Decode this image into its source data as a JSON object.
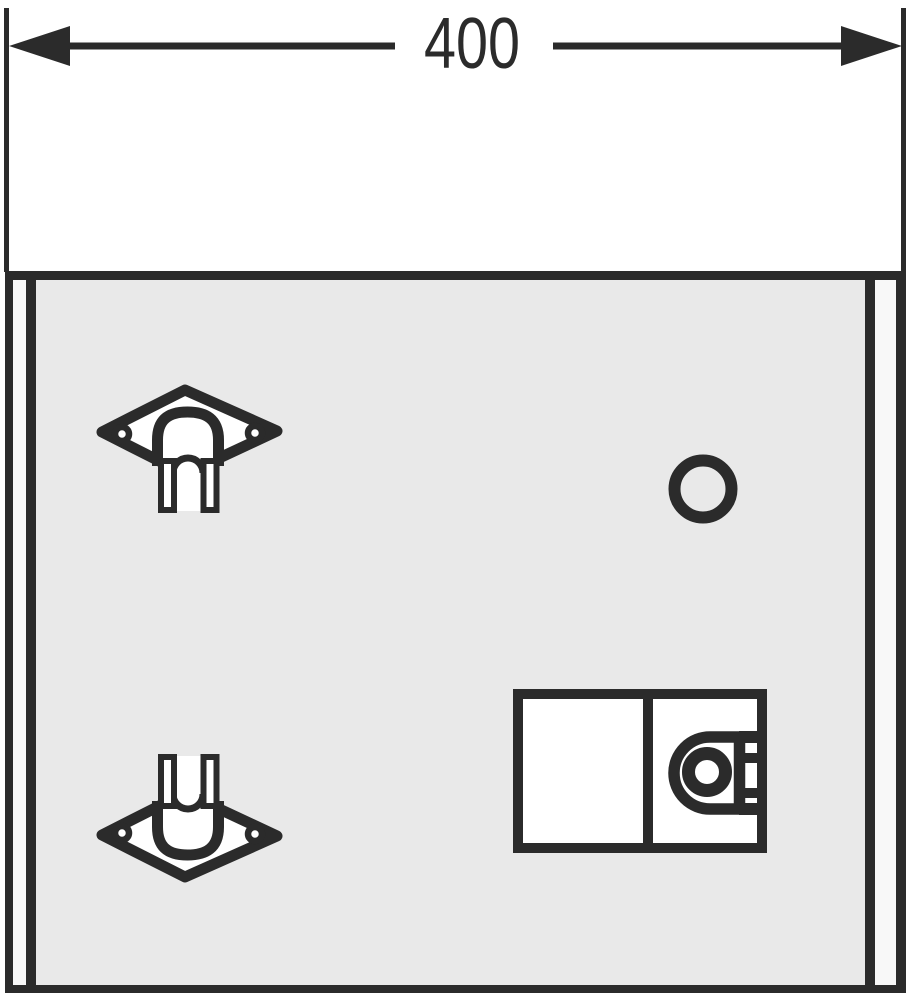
{
  "drawing": {
    "type": "technical-drawing",
    "dimension": {
      "label": "400"
    },
    "colors": {
      "ink": "#2b2b2b",
      "panel-fill": "#e9e9e9",
      "edge-strip": "#f8f8f8",
      "background": "#ffffff"
    },
    "components": {
      "panel": "front-panel",
      "clip_top": "pipe-clip",
      "clip_bottom": "pipe-clip",
      "hole": "knockout-hole",
      "latch": "inspection-latch-with-lock"
    }
  }
}
